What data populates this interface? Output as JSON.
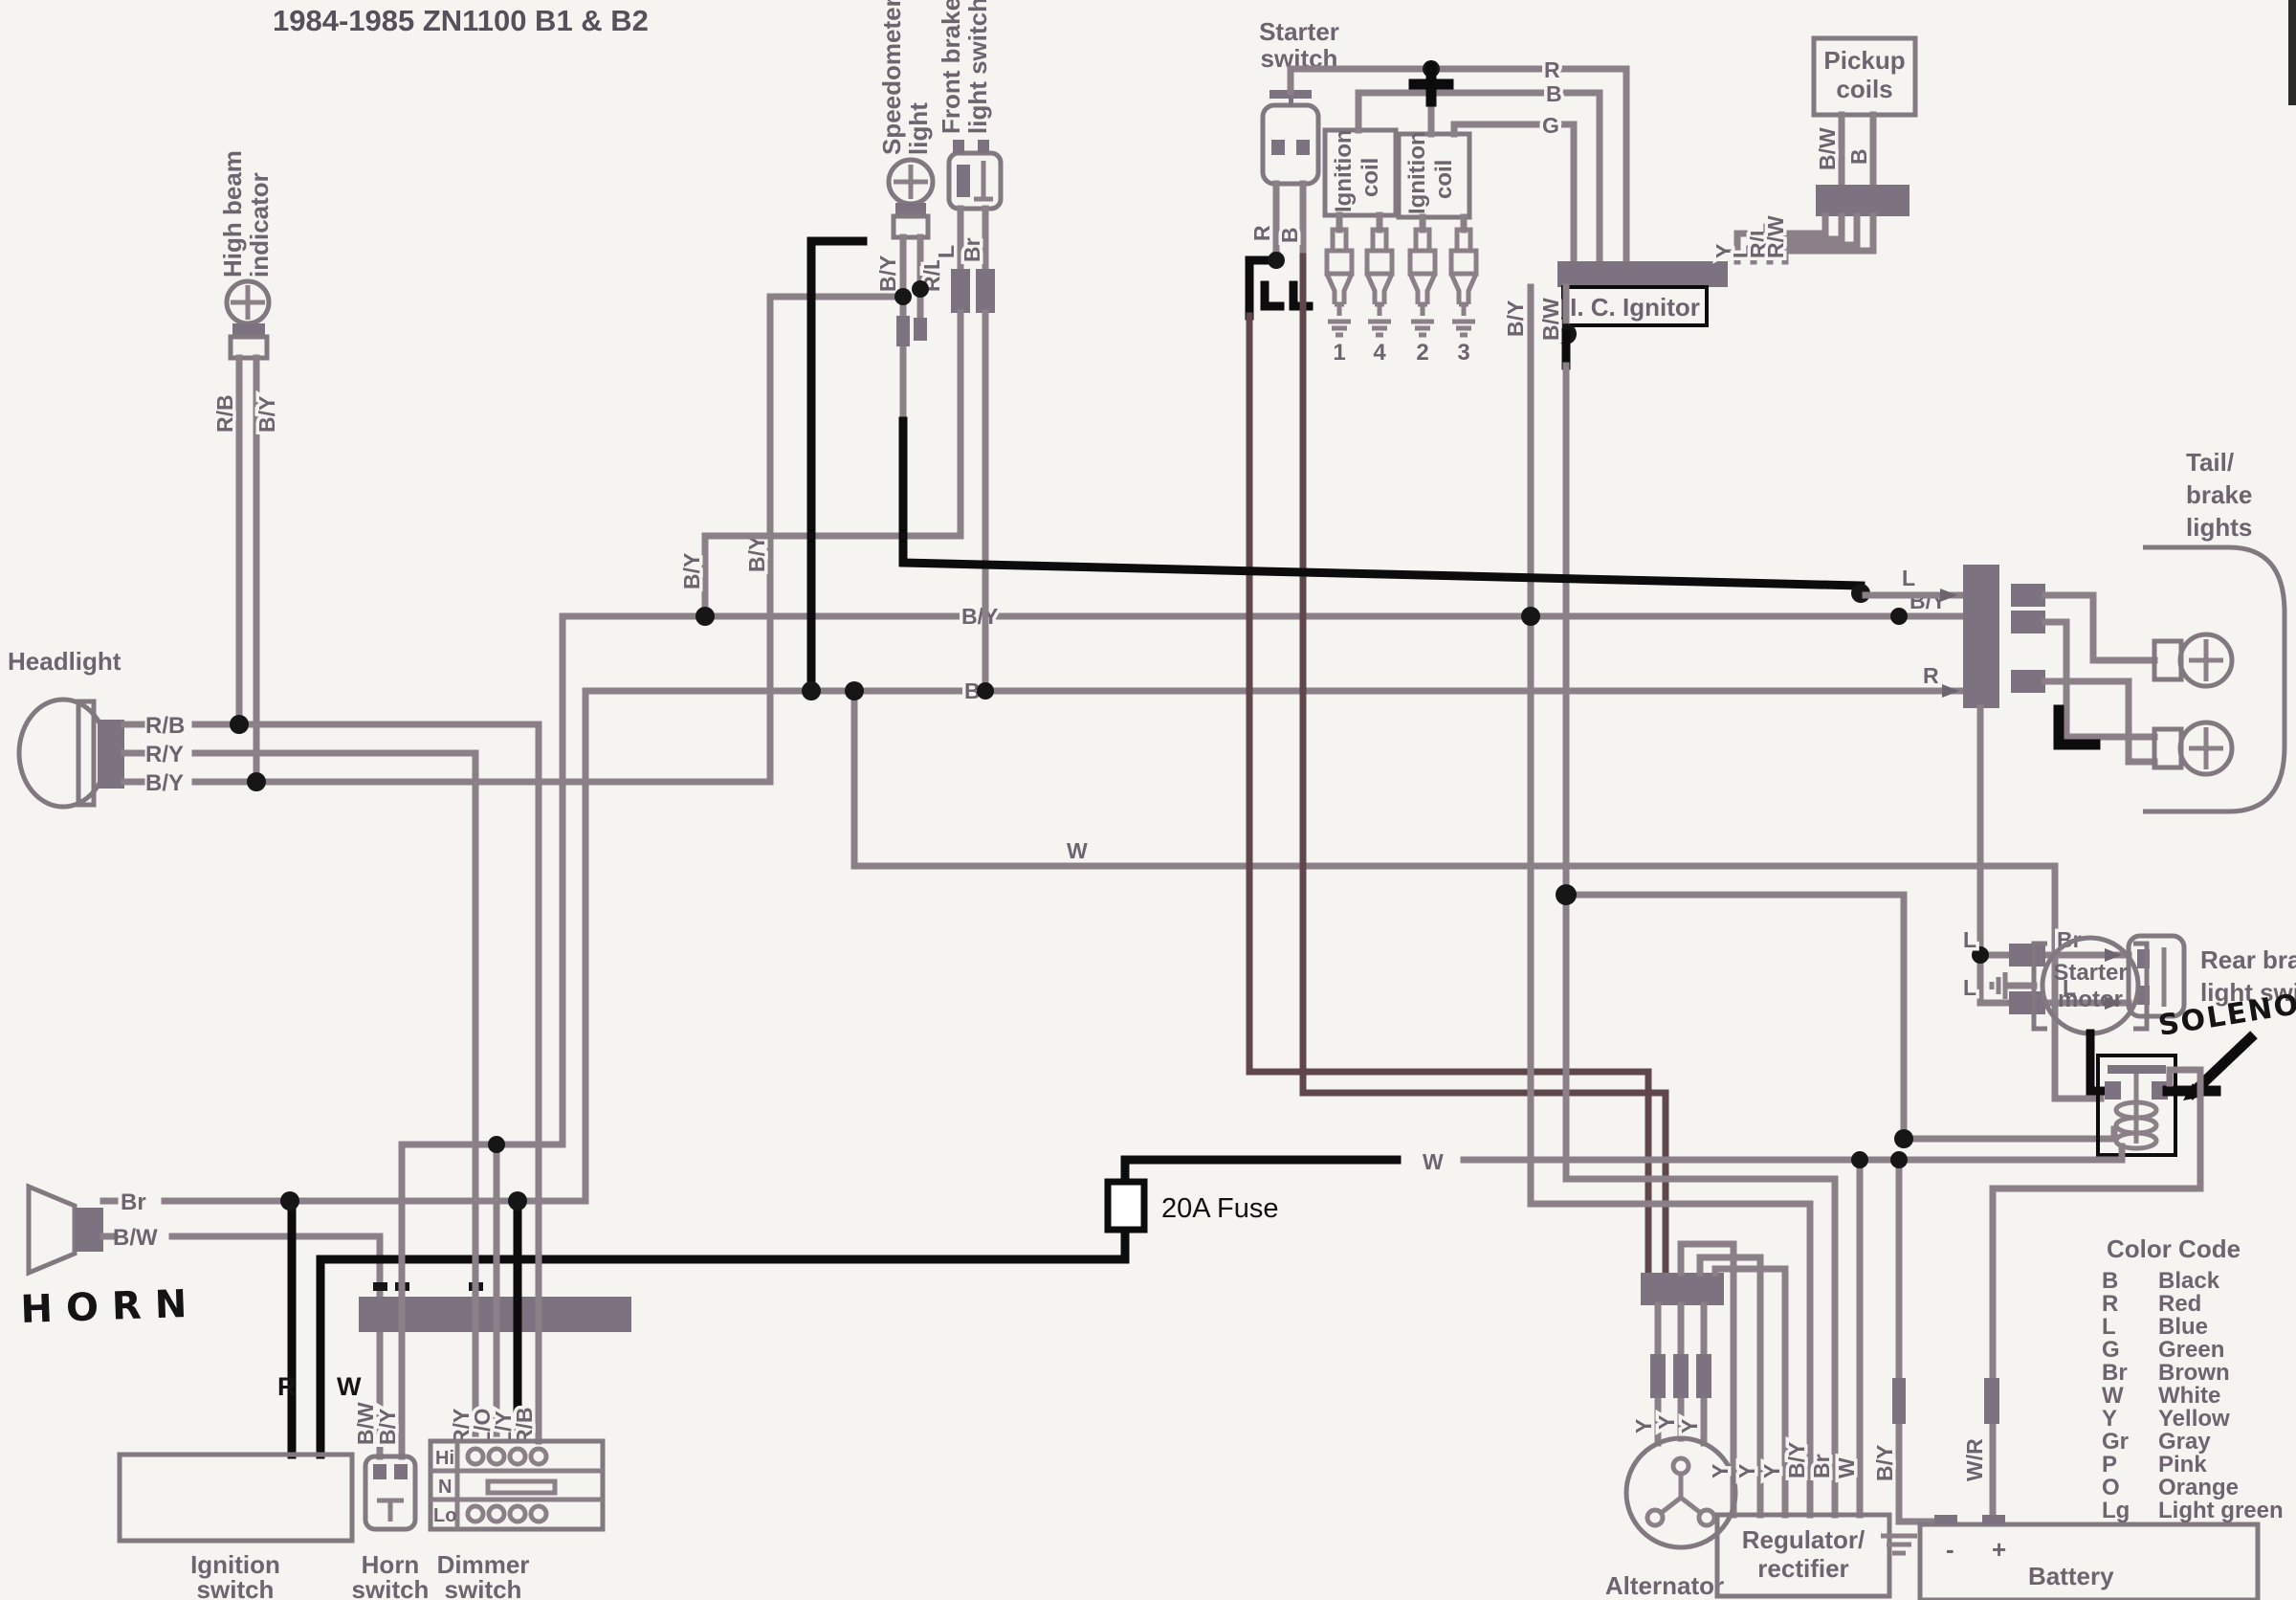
{
  "title": "1984-1985 ZN1100 B1 & B2",
  "legend": {
    "title": "Color Code",
    "entries": [
      {
        "code": "B",
        "name": "Black"
      },
      {
        "code": "R",
        "name": "Red"
      },
      {
        "code": "L",
        "name": "Blue"
      },
      {
        "code": "G",
        "name": "Green"
      },
      {
        "code": "Br",
        "name": "Brown"
      },
      {
        "code": "W",
        "name": "White"
      },
      {
        "code": "Y",
        "name": "Yellow"
      },
      {
        "code": "Gr",
        "name": "Gray"
      },
      {
        "code": "P",
        "name": "Pink"
      },
      {
        "code": "O",
        "name": "Orange"
      },
      {
        "code": "Lg",
        "name": "Light green"
      }
    ]
  },
  "bus_labels": {
    "by_mid": "B/Y",
    "br_mid": "Br",
    "w_mid": "W",
    "w_fuse": "W",
    "l_tail": "L",
    "by_tail": "B/Y",
    "r_tail": "R",
    "by_headlamp_riser": "B/Y",
    "by_brake_riser": "B/Y"
  },
  "components": {
    "headlight": {
      "label": "Headlight",
      "wires": [
        "R/B",
        "R/Y",
        "B/Y"
      ]
    },
    "high_beam_indicator": {
      "l1": "High beam",
      "l2": "indicator",
      "wires": [
        "R/B",
        "B/Y"
      ]
    },
    "speedometer_light": {
      "l1": "Speedometer",
      "l2": "light",
      "wires": [
        "B/Y",
        "R/L"
      ]
    },
    "front_brake_switch": {
      "l1": "Front brake",
      "l2": "light switch",
      "wires": [
        "L",
        "Br"
      ]
    },
    "starter_switch": {
      "l1": "Starter",
      "l2": "switch",
      "wires": [
        "R",
        "B"
      ]
    },
    "ignition_coil": {
      "l1": "Ignition",
      "l2": "coil"
    },
    "spark_plugs": [
      "1",
      "4",
      "2",
      "3"
    ],
    "coil_bus": {
      "r": "R",
      "b": "B",
      "g": "G"
    },
    "pickup_coils": {
      "l1": "Pickup",
      "l2": "coils",
      "wires": [
        "B/W",
        "B"
      ]
    },
    "ic_ignitor": {
      "label": "I. C. Ignitor",
      "left_wires": [
        "B/Y",
        "B/W"
      ],
      "right_wires": [
        "Y",
        "L",
        "R/L",
        "R/W"
      ]
    },
    "tail_brake_lights": {
      "l1": "Tail/",
      "l2": "brake",
      "l3": "lights"
    },
    "rear_brake_switch": {
      "l1": "Rear brake",
      "l2": "light switch",
      "left_wires": [
        "L",
        "L"
      ],
      "right_wires": [
        "Br",
        "L"
      ]
    },
    "starter_motor": {
      "l1": "Starter",
      "l2": "motor"
    },
    "solenoid": {
      "label": "SOLENOID"
    },
    "horn": {
      "label": "HORN",
      "wires": [
        "Br",
        "B/W"
      ]
    },
    "ignition_switch": {
      "l1": "Ignition",
      "l2": "switch",
      "wires": [
        "R",
        "W"
      ]
    },
    "horn_switch": {
      "l1": "Horn",
      "l2": "switch",
      "wires": [
        "B/W",
        "B/Y"
      ]
    },
    "dimmer_switch": {
      "l1": "Dimmer",
      "l2": "switch",
      "wires": [
        "R/Y",
        "L/O",
        "L/Y",
        "R/B"
      ],
      "positions": [
        "Hi",
        "N",
        "Lo"
      ]
    },
    "alternator": {
      "label": "Alternator",
      "wires": [
        "Y",
        "Y",
        "Y"
      ]
    },
    "regulator_rectifier": {
      "l1": "Regulator/",
      "l2": "rectifier",
      "wires": [
        "Y",
        "Y",
        "Y",
        "B/Y",
        "Br",
        "W"
      ]
    },
    "battery": {
      "label": "Battery",
      "neg": "-",
      "pos": "+",
      "wires": [
        "B/Y",
        "W/R"
      ]
    },
    "fuse": {
      "label": "20A Fuse"
    }
  }
}
